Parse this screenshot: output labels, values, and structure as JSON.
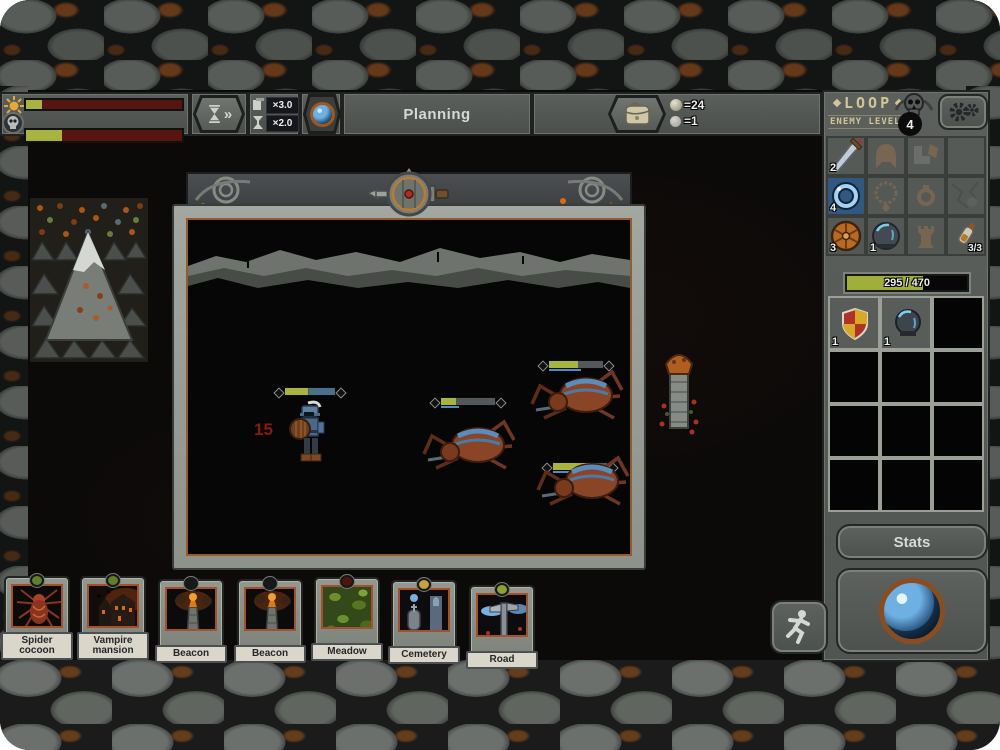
{
  "hud": {
    "phase_label": "Planning",
    "day_bar": {
      "fill_pct": 10
    },
    "boss_bar": {
      "fill_pct": 23
    },
    "speed": {
      "multiplier_card": "×3.0",
      "multiplier_time": "×2.0"
    },
    "resources": {
      "orbs": "=24",
      "pebbles": "=1"
    }
  },
  "sidebar": {
    "title": "LOOP",
    "enemy_level_label": "ENEMY LEVEL",
    "enemy_level_value": "4",
    "equipment": {
      "sword_count": "2",
      "ring_count": "4",
      "shield_count": "3",
      "helmet_count": "1",
      "potion_count": "3/3"
    },
    "hp_bar": {
      "text": "295 / 470",
      "fill_pct": 63
    },
    "inventory": {
      "shield_count": "1",
      "helmet_count": "1"
    },
    "stats_label": "Stats"
  },
  "battle": {
    "damage_number": "15",
    "hero": {
      "hp_pct": 45
    },
    "enemies": [
      {
        "name": "spider",
        "hp_pct": 28
      },
      {
        "name": "spider",
        "hp_pct": 53
      },
      {
        "name": "spider",
        "hp_pct": 68
      }
    ]
  },
  "cards": [
    {
      "name": "Spider cocoon",
      "gem": "#5f7f2a"
    },
    {
      "name": "Vampire mansion",
      "gem": "#5f7f2a"
    },
    {
      "name": "Beacon",
      "gem": "#17181a"
    },
    {
      "name": "Beacon",
      "gem": "#17181a"
    },
    {
      "name": "Meadow",
      "gem": "#4e150d"
    },
    {
      "name": "Cemetery",
      "gem": "#c9a23b"
    },
    {
      "name": "Road",
      "gem": "#8aa32e"
    }
  ]
}
